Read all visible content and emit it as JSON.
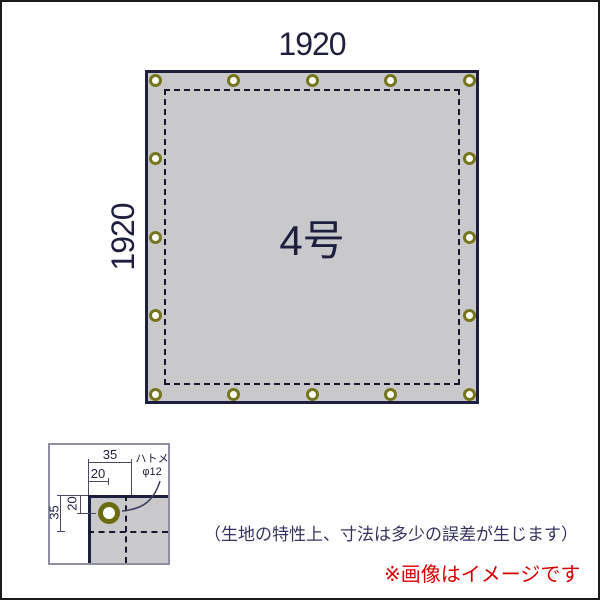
{
  "diagram": {
    "width_label": "1920",
    "height_label": "1920",
    "size_label": "4号",
    "grommets_per_side": 5
  },
  "detail": {
    "dim_top_outer": "35",
    "dim_top_inner": "20",
    "dim_left_outer": "35",
    "dim_left_inner": "20",
    "grommet_label_line1": "ハトメ",
    "grommet_label_line2": "φ12"
  },
  "notes": {
    "tolerance": "（生地の特性上、寸法は多少の誤差が生じます）",
    "image_disclaimer": "※画像はイメージです"
  },
  "colors": {
    "tarp_fill": "#c9c9cc",
    "tarp_border": "#1e1e3e",
    "grommet_ring": "#75751e",
    "grommet_ring_dark": "#6b6b12",
    "dash": "#15152e",
    "dim_line": "#4a4a66",
    "inset_border": "#8f8fa3",
    "note_text": "#34345e",
    "disclaimer_red": "#d40000"
  }
}
